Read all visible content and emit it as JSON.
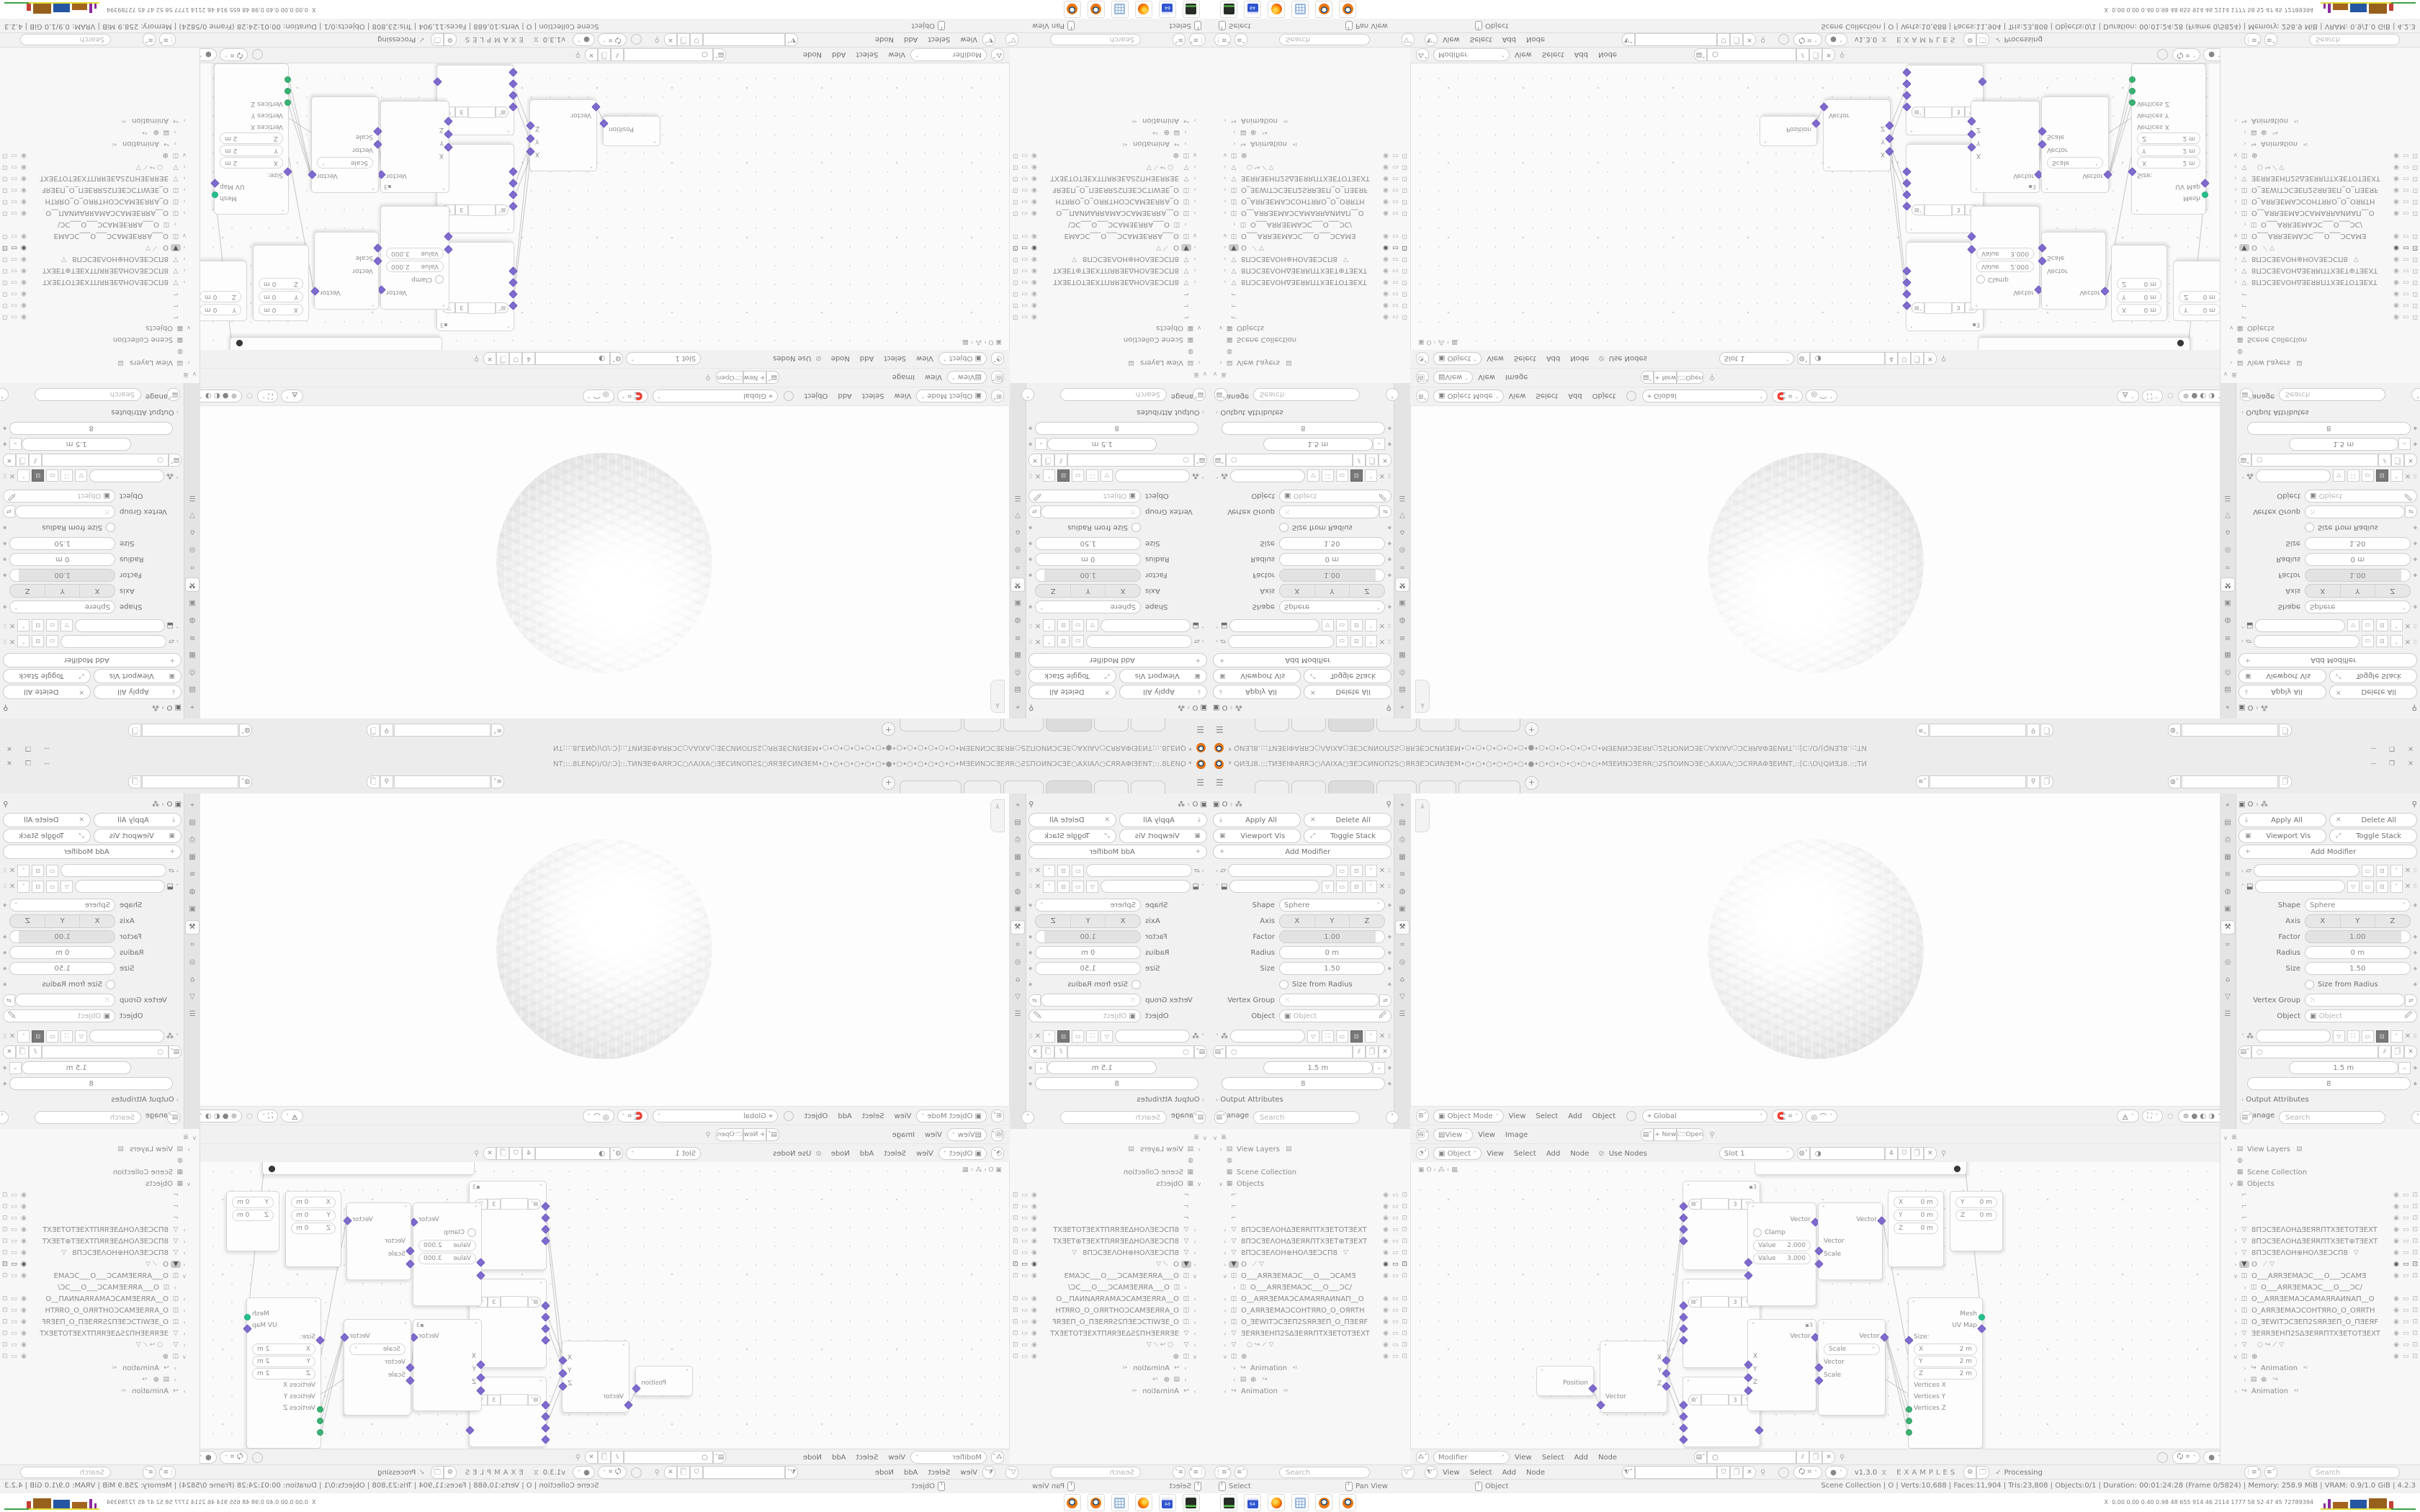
{
  "colors": {
    "accent_orange": "#f0760d",
    "socket_vector": "#7f6ace",
    "socket_geometry": "#27c08d",
    "socket_int": "#3bb273",
    "hist_yellow": "#e0dd3a",
    "hist_purple": "#8a2a9b",
    "hist_brown": "#96601c",
    "hist_blue": "#2456a2",
    "hist_red": "#c23f35",
    "hist_green": "#43a047"
  },
  "window": {
    "title": "* QИƎ⅃8.::;TИƎEIΦAЯRƆ○ΛAIXA○ƎEƆCИNOΠ2S○ЯRƎEƆCИNƎEM•○•○•○•○•○•○•●•○•○•○•○•○•○•MƎEИNƆƎEЯR○2SΠOИNƆƎE○AXIAΛ○ƆCЯRAΦƎEИNT,::[C:\\O\\(QИƎ⅃8.::;TИ",
    "buttons": {
      "minimize": "—",
      "restore": "❐",
      "close": "✕"
    },
    "topbar": {
      "menu_icon": "☰",
      "add_tab": "+",
      "tabs": [
        "",
        "",
        "",
        "",
        "",
        ""
      ]
    },
    "properties": {
      "breadcrumb": {
        "object_icon": "▣",
        "object": "O",
        "chev": "›",
        "nodes_icon": "⁂",
        "pin": "⚲"
      },
      "toolbar": {
        "apply_all": "Apply All",
        "delete_all": "Delete All",
        "viewport_vis": "Viewport Vis",
        "toggle_stack": "Toggle Stack",
        "add_modifier": "Add Modifier"
      },
      "modifier": {
        "shape_label": "Shape",
        "shape": "Sphere",
        "axis_label": "Axis",
        "axis": [
          "X",
          "Y",
          "Z"
        ],
        "factor_label": "Factor",
        "factor": "1.00",
        "radius_label": "Radius",
        "radius": "0 m",
        "size_label": "Size",
        "size": "1.50",
        "size_from_radius": "Size from Radius",
        "vertex_group_label": "Vertex Group",
        "object_label": "Object",
        "object_placeholder": "Object"
      },
      "nodes_modifier": {
        "spacing": "1.5 m",
        "count": "8",
        "output_attributes": "Output Attributes",
        "manage": "Manage"
      },
      "search_placeholder": "Search"
    },
    "viewport": {
      "mode": "Object Mode",
      "menus": [
        "View",
        "Select",
        "Add",
        "Object"
      ],
      "orientation": "Global"
    },
    "image_editor": {
      "menus": [
        "View",
        "Image"
      ],
      "new_button": "+ New",
      "open_button": "Open"
    },
    "shader": {
      "object_mode": "Object",
      "menus": [
        "View",
        "Select",
        "Add",
        "Node"
      ],
      "use_nodes": "Use Nodes",
      "slot": "Slot 1",
      "users": "4"
    },
    "node_editor": {
      "breadcrumb": "▣ O › ⁂ › ▦",
      "mode": "Modifier",
      "menus": [
        "View",
        "Select",
        "Add",
        "Node"
      ],
      "menus2": [
        "View",
        "Select",
        "Add",
        "Node"
      ],
      "version": "v1.3.0",
      "brand": "EXAMPLES",
      "status_check": "✓",
      "status": "Processing"
    },
    "outliner": {
      "search_placeholder": "Search",
      "rows": [
        {
          "arrow": "v",
          "icon": "scene",
          "name": ""
        },
        {
          "arrow": "›",
          "icon": "image",
          "name": "View Layers",
          "extra": "▤"
        },
        {
          "icon": "globe",
          "name": ""
        },
        {
          "icon": "collection",
          "name": "Scene Collection"
        },
        {
          "arrow": "v",
          "icon": "collection",
          "name": "Objects"
        },
        {
          "icon": "empty",
          "name": "",
          "toggles": true
        },
        {
          "icon": "empty",
          "name": "",
          "toggles": true
        },
        {
          "icon": "empty",
          "name": "",
          "toggles": true
        },
        {
          "arrow": "›",
          "icon": "mesh",
          "name": "8ПƆCƎEΛOHΔƎEЯRПTXƎETOTƎEXT",
          "toggles": true
        },
        {
          "arrow": "›",
          "icon": "mesh",
          "name": "8ПƆCƎEΛOHΔƎEЯRПTXƎET⊕TƎEXT",
          "toggles": true
        },
        {
          "arrow": "›",
          "icon": "mesh",
          "name": "8ПƆCƎEΛOH⊕HOΛƎEƆCП8",
          "extra": "▽",
          "toggles": true
        },
        {
          "arrow": "›",
          "icon": "mesh_sel",
          "name": "O",
          "extra": "⟋ ▽",
          "toggles": true,
          "selected": true
        },
        {
          "arrow": "v",
          "icon": "camera",
          "name": "O___AЯRƎEMAƆC___O___ƆCAMƎ",
          "toggles": true
        },
        {
          "arrow": "›",
          "icon": "camdata",
          "name": "O___AЯRƎEMAƆC___O___ƆC∕",
          "indent": 1
        },
        {
          "arrow": "›",
          "icon": "camera",
          "name": "O__AЯRƎEMAƆCAMAЯRAИNAП__O",
          "toggles": true
        },
        {
          "arrow": "›",
          "icon": "camera",
          "name": "O_AЯRƎEMAƆCOHTЯRO_O_OЯRTH",
          "toggles": true
        },
        {
          "arrow": "›",
          "icon": "camera",
          "name": "O_ƎEWITƆCƎEП2SЯRƎEП_O_ПƎEЯF",
          "toggles": true
        },
        {
          "arrow": "›",
          "icon": "mesh",
          "name": "ƎEЯRƎEHП2SΔƎEЯRПTXƎETOTƎEXT",
          "toggles": true
        },
        {
          "arrow": "›",
          "icon": "mesh",
          "name": "",
          "extra": "○  ↪ ⟋ ▽",
          "toggles": true
        },
        {
          "arrow": "v",
          "icon": "camera",
          "name": "⊕",
          "toggles": true
        },
        {
          "arrow": "›",
          "icon": "anim",
          "name": "Animation",
          "badge": "⁴²",
          "indent": 1
        },
        {
          "arrow": "›",
          "icon": "strip",
          "name": "⊕",
          "extra": "↪",
          "indent": 1
        },
        {
          "arrow": "›",
          "icon": "anim",
          "name": "Animation",
          "badge": "⁴²"
        }
      ]
    },
    "nodes": {
      "position": {
        "label": "Position"
      },
      "separate": {
        "outputs": [
          "X",
          "Y",
          "Z"
        ],
        "input": "Vector"
      },
      "group": {
        "users": "3"
      },
      "map_range": {
        "output": "Vector",
        "clamp": "Clamp",
        "value1_label": "Value",
        "value1": "2.000",
        "value2_label": "Value",
        "value2": "3.000"
      },
      "combine": {
        "output": "Vector",
        "inputs": [
          "X",
          "Y",
          "Z"
        ],
        "users": "3"
      },
      "vm_top": {
        "output": "Vector",
        "inputs": [
          "Vector",
          "Scale"
        ]
      },
      "vm_scale": {
        "output": "Vector",
        "op": "Scale",
        "inputs": [
          "Vector",
          "Scale"
        ]
      },
      "xyz1": {
        "rows": [
          [
            "X",
            "0 m"
          ],
          [
            "Y",
            "0 m"
          ],
          [
            "Z",
            "0 m"
          ]
        ]
      },
      "xyz2": {
        "rows": [
          [
            "Y",
            "0 m"
          ],
          [
            "Z",
            "0 m"
          ]
        ]
      },
      "cube": {
        "outputs": [
          "Mesh",
          "UV Map"
        ],
        "size_label": "Size:",
        "size_rows": [
          [
            "X",
            "2 m"
          ],
          [
            "Y",
            "2 m"
          ],
          [
            "Z",
            "2 m"
          ]
        ],
        "inputs": [
          "Vertices X",
          "Vertices Y",
          "Vertices Z"
        ]
      }
    },
    "statusbar": {
      "hints": [
        "Select",
        "Pan View",
        "Object"
      ],
      "stats": "Scene Collection | O | Verts:10,688 | Faces:11,904 | Tris:23,808 | Objects:0/1 | Duration: 00:01:24:28 (Frame 0/5824) | Memory: 258.9 MiB | VRAM: 0.9/1.0 GiB | 4.2.3"
    },
    "taskbar": {
      "apps": [
        "disk-utility",
        "floppy-64",
        "firefox",
        "calculator",
        "blender",
        "blender"
      ],
      "floppy_label": "64",
      "person_icon": "Ẋ",
      "histogram_values": "0.00 0.00 0.40 0.98  48  655  914  46  2114 1777  58   52   47   45  72789394",
      "histogram_bars": [
        {
          "c": "#8a2a9b",
          "h": 7,
          "w": 3
        },
        {
          "c": "#8a2a9b",
          "h": 13,
          "w": 4
        },
        {
          "c": "#a2641f",
          "h": 9,
          "w": 21
        },
        {
          "c": "#2456a2",
          "h": 12,
          "w": 23
        },
        {
          "c": "#96601c",
          "h": 14,
          "w": 25
        },
        {
          "c": "#c23f35",
          "h": 10,
          "w": 6
        }
      ]
    }
  }
}
